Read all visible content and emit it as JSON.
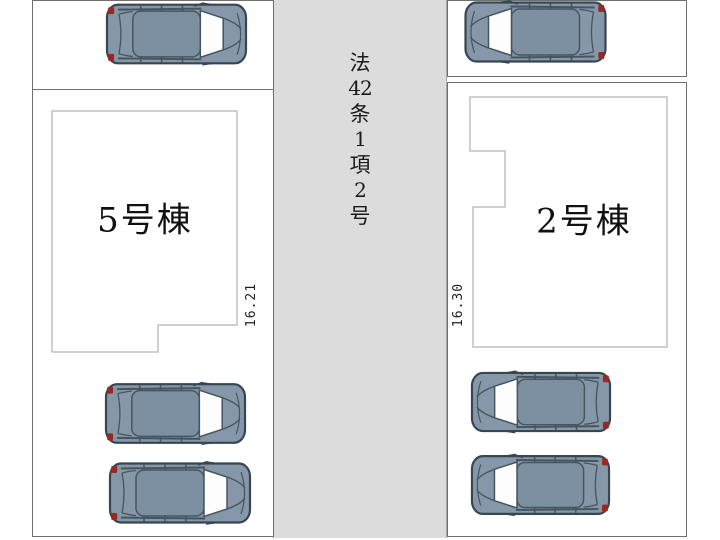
{
  "road": {
    "label": "法42条1項2号",
    "label_chars": [
      "法",
      "42",
      "条",
      "1",
      "項",
      "2",
      "号"
    ],
    "fill_color": "#dcdcdc"
  },
  "lots": {
    "left": {
      "building_label": "5号棟",
      "frontage_measurement": "16.21",
      "parked_cars": 3
    },
    "right": {
      "building_label": "2号棟",
      "frontage_measurement": "16.30",
      "parked_cars": 3
    }
  },
  "cars": [
    {
      "location": "left-lot-top",
      "facing": "right"
    },
    {
      "location": "right-lot-top",
      "facing": "left"
    },
    {
      "location": "left-lot-middle",
      "facing": "right"
    },
    {
      "location": "left-lot-bottom",
      "facing": "right"
    },
    {
      "location": "right-lot-middle",
      "facing": "left"
    },
    {
      "location": "right-lot-bottom",
      "facing": "left"
    }
  ],
  "colors": {
    "road_fill": "#dcdcdc",
    "lot_border": "#707070",
    "building_border": "#c0c0c0",
    "car_body": "#8597a8",
    "car_roof": "#7d90a1",
    "car_outline": "#374650",
    "taillight": "#992722"
  }
}
